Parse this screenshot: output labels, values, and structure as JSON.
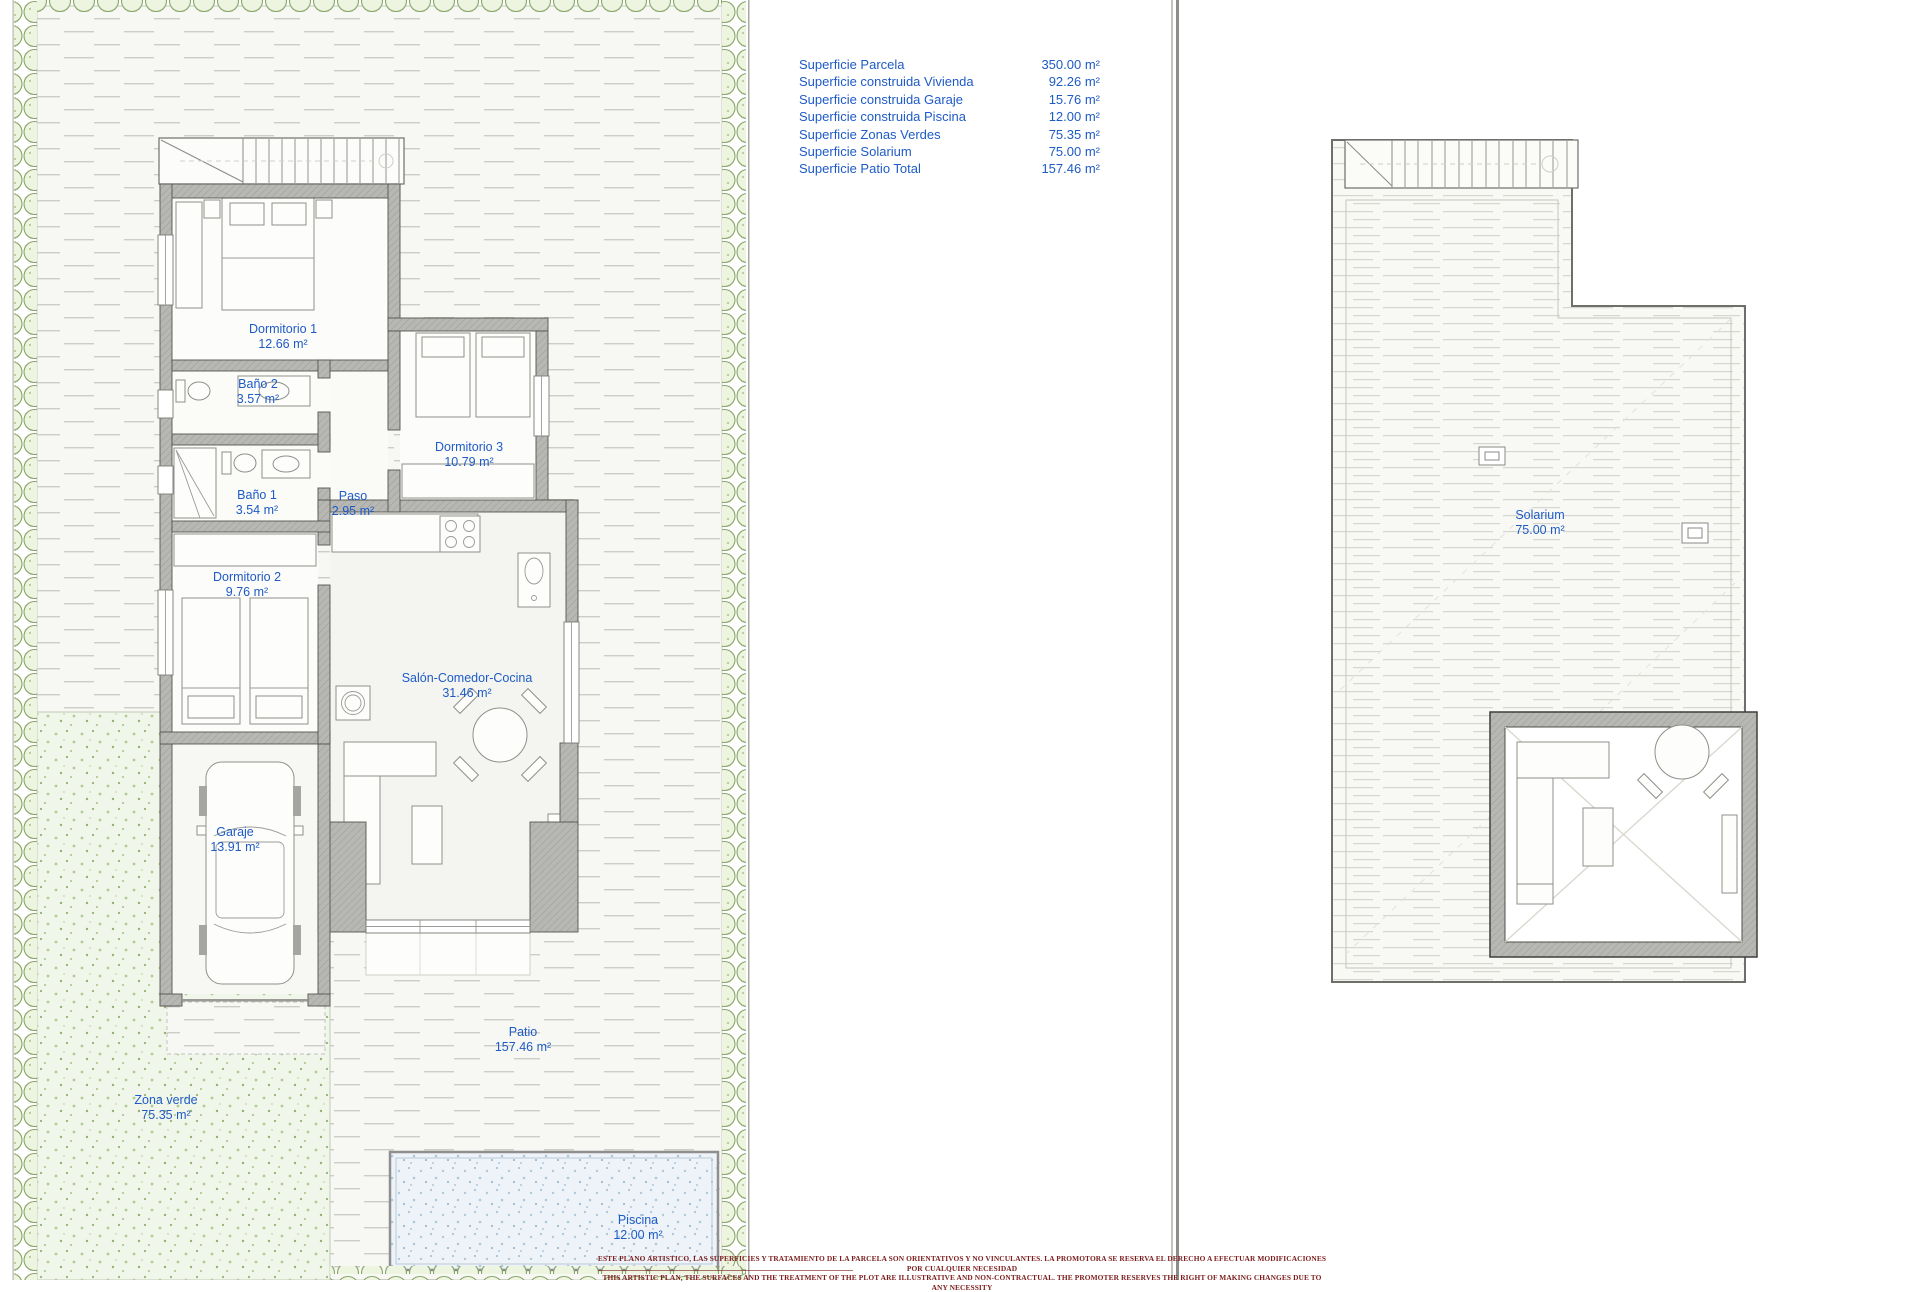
{
  "legend": {
    "rows": [
      {
        "label": "Superficie Parcela",
        "value": "350.00 m²"
      },
      {
        "label": "Superficie construida Vivienda",
        "value": "92.26 m²"
      },
      {
        "label": "Superficie construida Garaje",
        "value": "15.76 m²"
      },
      {
        "label": "Superficie construida Piscina",
        "value": "12.00 m²"
      },
      {
        "label": "Superficie Zonas Verdes",
        "value": "75.35 m²"
      },
      {
        "label": "Superficie Solarium",
        "value": "75.00 m²"
      },
      {
        "label": "Superficie Patio Total",
        "value": "157.46 m²"
      }
    ]
  },
  "rooms": {
    "dormitorio1": {
      "name": "Dormitorio 1",
      "area": "12.66 m²"
    },
    "bano2": {
      "name": "Baño 2",
      "area": "3.57 m²"
    },
    "dormitorio3": {
      "name": "Dormitorio 3",
      "area": "10.79 m²"
    },
    "bano1": {
      "name": "Baño 1",
      "area": "3.54 m²"
    },
    "paso": {
      "name": "Paso",
      "area": "2.95 m²"
    },
    "dormitorio2": {
      "name": "Dormitorio 2",
      "area": "9.76 m²"
    },
    "salon": {
      "name": "Salón-Comedor-Cocina",
      "area": "31.46 m²"
    },
    "garaje": {
      "name": "Garaje",
      "area": "13.91 m²"
    },
    "patio": {
      "name": "Patio",
      "area": "157.46 m²"
    },
    "zona_verde": {
      "name": "Zona verde",
      "area": "75.35 m²"
    },
    "piscina": {
      "name": "Piscina",
      "area": "12.00 m²"
    },
    "solarium": {
      "name": "Solarium",
      "area": "75.00 m²"
    }
  },
  "disclaimer": {
    "line_es": "ESTE PLANO ARTISTICO, LAS SUPERFICIES Y TRATAMIENTO DE LA PARCELA SON ORIENTATIVOS Y NO VINCULANTES. LA PROMOTORA SE RESERVA EL DERECHO A EFECTUAR MODIFICACIONES POR CUALQUIER NECESIDAD",
    "line_en": "THIS ARTISTIC PLAN, THE SURFACES AND THE TREATMENT OF THE PLOT ARE ILLUSTRATIVE AND NON-CONTRACTUAL. THE PROMOTER RESERVES THE RIGHT OF MAKING CHANGES DUE TO ANY NECESSITY"
  },
  "colors": {
    "label_blue": "#1e5bc6",
    "disclaimer_red": "#7b1d1d",
    "hedge_green": "#86a566",
    "wall_gray": "#b7b7b4",
    "pool_blue": "#b0c9db"
  }
}
